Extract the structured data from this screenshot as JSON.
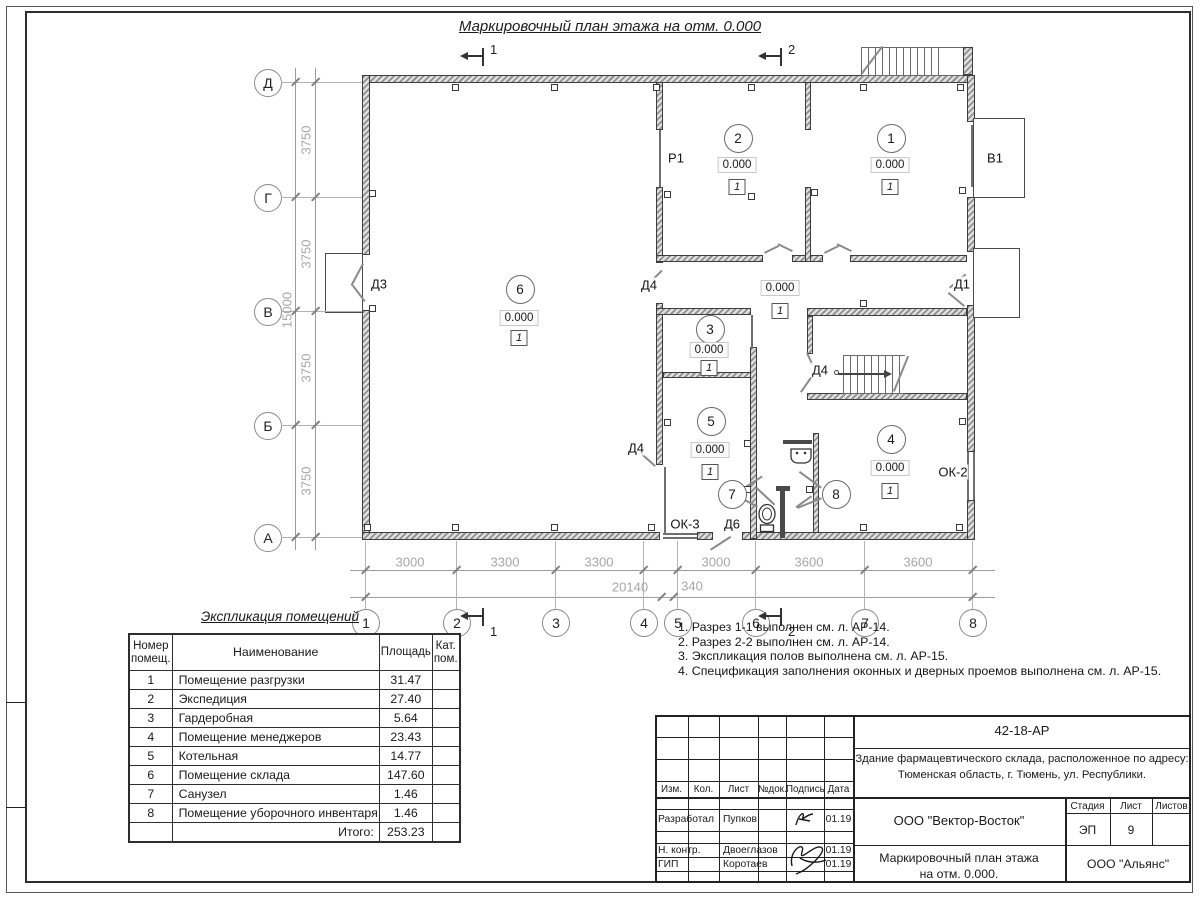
{
  "sheet": {
    "plan_title": "Маркировочный план этажа на отм. 0.000",
    "stamp": {
      "doc_number": "42-18-АР",
      "object_line1": "Здание фармацевтического склада, расположенное по адресу:",
      "object_line2": "Тюменская область, г. Тюмень, ул. Республики.",
      "org_design": "ООО \"Вектор-Восток\"",
      "org_customer": "ООО \"Альянс\"",
      "sheet_title_line1": "Маркировочный план этажа",
      "sheet_title_line2": "на отм. 0.000.",
      "stage_label": "Стадия",
      "stage_value": "ЭП",
      "sheet_label": "Лист",
      "sheet_value": "9",
      "sheets_label": "Листов",
      "cols": [
        "Изм.",
        "Кол.",
        "Лист",
        "№док.",
        "Подпись",
        "Дата"
      ],
      "rows": [
        {
          "role": "Разработал",
          "name": "Пупков",
          "date": "01.19"
        },
        {
          "role": "Н. контр.",
          "name": "Двоеглазов",
          "date": "01.19"
        },
        {
          "role": "ГИП",
          "name": "Коротаев",
          "date": "01.19"
        }
      ]
    }
  },
  "legend": {
    "title": "Экспликация помещений",
    "headers": [
      "Номер\nпомещ.",
      "Наименование",
      "Площадь",
      "Кат.\nпом."
    ],
    "rows": [
      [
        "1",
        "Помещение разгрузки",
        "31.47",
        ""
      ],
      [
        "2",
        "Экспедиция",
        "27.40",
        ""
      ],
      [
        "3",
        "Гардеробная",
        "5.64",
        ""
      ],
      [
        "4",
        "Помещение менеджеров",
        "23.43",
        ""
      ],
      [
        "5",
        "Котельная",
        "14.77",
        ""
      ],
      [
        "6",
        "Помещение склада",
        "147.60",
        ""
      ],
      [
        "7",
        "Санузел",
        "1.46",
        ""
      ],
      [
        "8",
        "Помещение уборочного инвентаря",
        "1.46",
        ""
      ]
    ],
    "total_label": "Итого:",
    "total_value": "253.23"
  },
  "notes": [
    "1. Разрез 1-1 выполнен см. л. АР-14.",
    "2. Разрез 2-2 выполнен см. л. АР-14.",
    "3. Экспликация полов выполнена см. л. АР-15.",
    "4. Спецификация заполнения оконных и дверных проемов выполнена см. л. АР-15."
  ],
  "plan": {
    "elevation_text": "0.000",
    "floor_type_text": "1",
    "room_marks": [
      {
        "num": "6",
        "x": 519,
        "cy": 288,
        "ey": 318,
        "fy": 338
      },
      {
        "num": "2",
        "x": 737,
        "cy": 137,
        "ey": 165,
        "fy": 187
      },
      {
        "num": "1",
        "x": 890,
        "cy": 137,
        "ey": 165,
        "fy": 187
      },
      {
        "num": "3",
        "x": 709,
        "cy": 328,
        "ey": 350,
        "fy": 368
      },
      {
        "num": "5",
        "x": 710,
        "cy": 420,
        "ey": 450,
        "fy": 472
      },
      {
        "num": "4",
        "x": 890,
        "cy": 438,
        "ey": 468,
        "fy": 491
      },
      {
        "num": "",
        "x": 780,
        "cy": null,
        "ey": 288,
        "fy": 311
      }
    ],
    "small_marks": [
      {
        "num": "7",
        "x": 731,
        "y": 493
      },
      {
        "num": "8",
        "x": 835,
        "y": 493
      }
    ],
    "tags": [
      {
        "text": "Д3",
        "x": 379,
        "y": 284
      },
      {
        "text": "Р1",
        "x": 676,
        "y": 158
      },
      {
        "text": "В1",
        "x": 995,
        "y": 158
      },
      {
        "text": "Д1",
        "x": 962,
        "y": 284
      },
      {
        "text": "Д4",
        "x": 649,
        "y": 285
      },
      {
        "text": "Д4",
        "x": 820,
        "y": 370
      },
      {
        "text": "Д4",
        "x": 636,
        "y": 448
      },
      {
        "text": "Д6",
        "x": 732,
        "y": 524
      },
      {
        "text": "ОК-3",
        "x": 685,
        "y": 524
      },
      {
        "text": "ОК-2",
        "x": 953,
        "y": 472
      }
    ],
    "axes_left": [
      {
        "label": "Д",
        "y": 82
      },
      {
        "label": "Г",
        "y": 197
      },
      {
        "label": "В",
        "y": 311
      },
      {
        "label": "Б",
        "y": 425
      },
      {
        "label": "А",
        "y": 537
      }
    ],
    "axes_bottom": [
      {
        "label": "1",
        "x": 365
      },
      {
        "label": "2",
        "x": 456
      },
      {
        "label": "3",
        "x": 555
      },
      {
        "label": "4",
        "x": 643
      },
      {
        "label": "5",
        "x": 677
      },
      {
        "label": "6",
        "x": 755
      },
      {
        "label": "7",
        "x": 864
      },
      {
        "label": "8",
        "x": 972
      }
    ],
    "dims_bottom_row1": [
      {
        "text": "3000",
        "x": 410
      },
      {
        "text": "3300",
        "x": 505
      },
      {
        "text": "3300",
        "x": 599
      },
      {
        "text": "3000",
        "x": 716
      },
      {
        "text": "3600",
        "x": 809
      },
      {
        "text": "3600",
        "x": 918
      }
    ],
    "dims_bottom_row2": [
      {
        "text": "20140",
        "x": 630,
        "y": 587
      },
      {
        "text": "340",
        "x": 692,
        "y": 586
      }
    ],
    "dim2_ticks": [
      365,
      661,
      673,
      972
    ],
    "dims_left": [
      {
        "text": "3750",
        "x": 306,
        "y": 140
      },
      {
        "text": "3750",
        "x": 306,
        "y": 254
      },
      {
        "text": "3750",
        "x": 306,
        "y": 368
      },
      {
        "text": "3750",
        "x": 306,
        "y": 481
      },
      {
        "text": "15000",
        "x": 287,
        "y": 310
      }
    ],
    "section_marks": [
      {
        "num": "1",
        "x": 483,
        "side": "top"
      },
      {
        "num": "2",
        "x": 781,
        "side": "top"
      },
      {
        "num": "1",
        "x": 483,
        "side": "bottom"
      },
      {
        "num": "2",
        "x": 781,
        "side": "bottom"
      }
    ]
  }
}
